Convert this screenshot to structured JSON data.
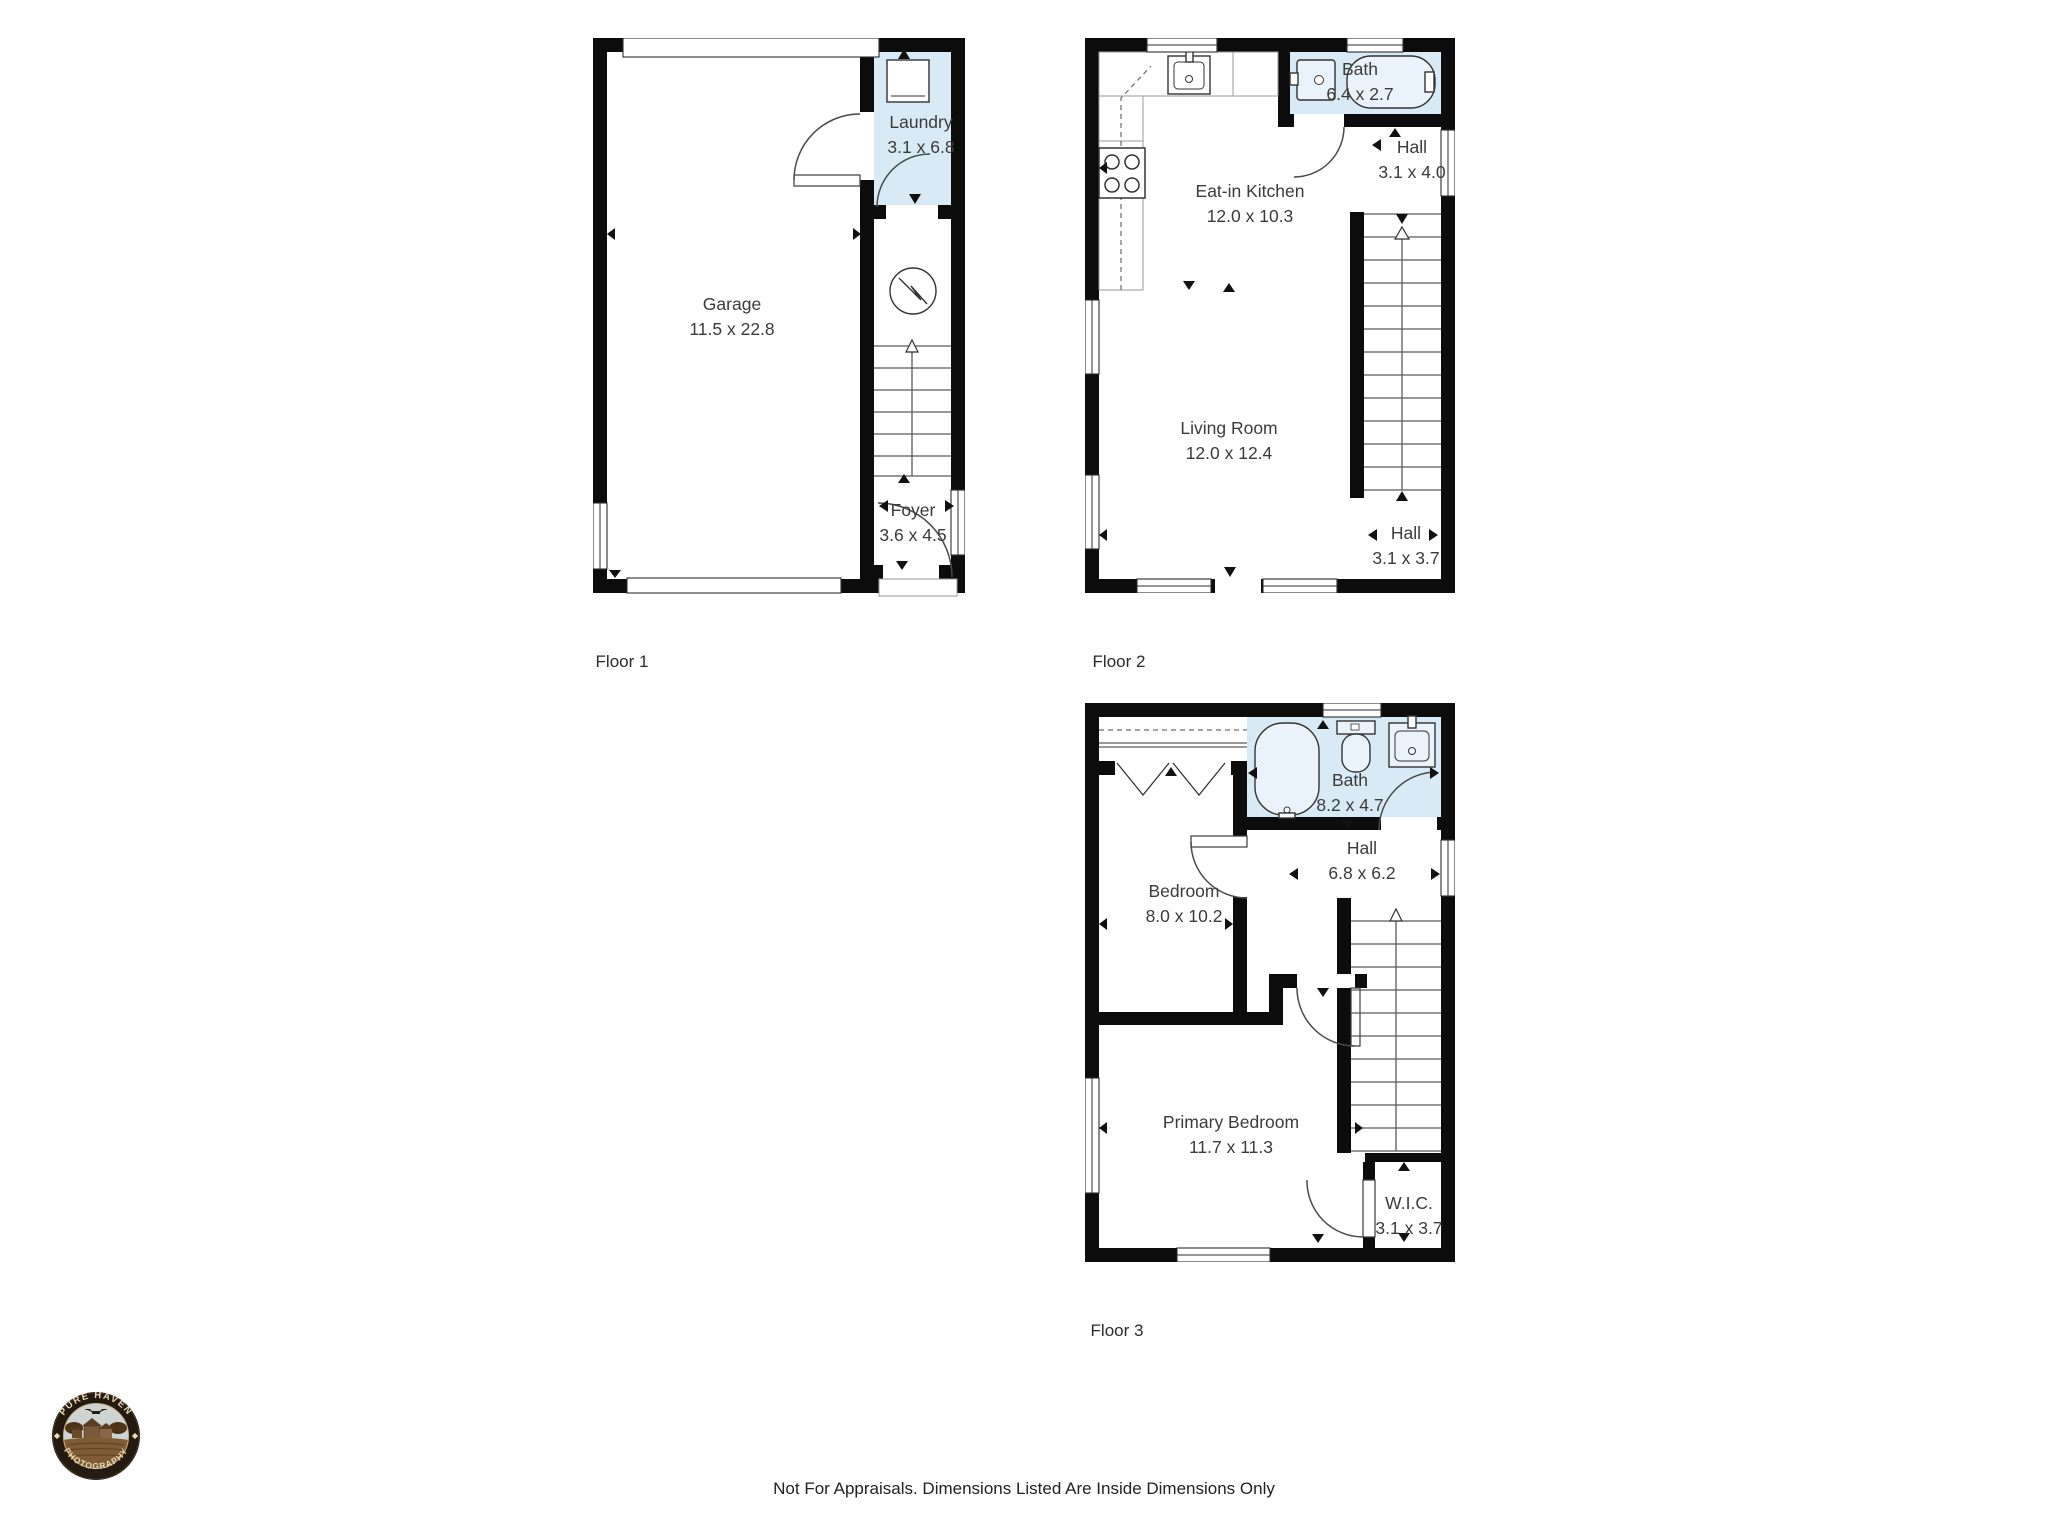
{
  "floors": [
    {
      "caption": "Floor 1",
      "rooms": [
        {
          "name": "Garage",
          "dims": "11.5 x 22.8"
        },
        {
          "name": "Laundry",
          "dims": "3.1 x 6.8"
        },
        {
          "name": "Foyer",
          "dims": "3.6 x 4.5"
        }
      ]
    },
    {
      "caption": "Floor 2",
      "rooms": [
        {
          "name": "Eat-in Kitchen",
          "dims": "12.0 x 10.3"
        },
        {
          "name": "Bath",
          "dims": "6.4 x 2.7"
        },
        {
          "name": "Hall",
          "dims": "3.1 x 4.0"
        },
        {
          "name": "Living Room",
          "dims": "12.0 x 12.4"
        },
        {
          "name": "Hall",
          "dims": "3.1 x 3.7"
        }
      ]
    },
    {
      "caption": "Floor 3",
      "rooms": [
        {
          "name": "Bath",
          "dims": "8.2 x 4.7"
        },
        {
          "name": "Hall",
          "dims": "6.8 x 6.2"
        },
        {
          "name": "Bedroom",
          "dims": "8.0 x 10.2"
        },
        {
          "name": "Primary Bedroom",
          "dims": "11.7 x 11.3"
        },
        {
          "name": "W.I.C.",
          "dims": "3.1 x 3.7"
        }
      ]
    }
  ],
  "footer": {
    "disclaimer": "Not For Appraisals. Dimensions Listed Are Inside Dimensions Only"
  },
  "logo": {
    "arc_top": "PURE HAVEN",
    "arc_bottom": "PHOTOGRAPHY"
  },
  "colors": {
    "wall": "#0c0c0c",
    "wet_room": "#d9eaf7",
    "label_text": "#3b3b3b"
  }
}
